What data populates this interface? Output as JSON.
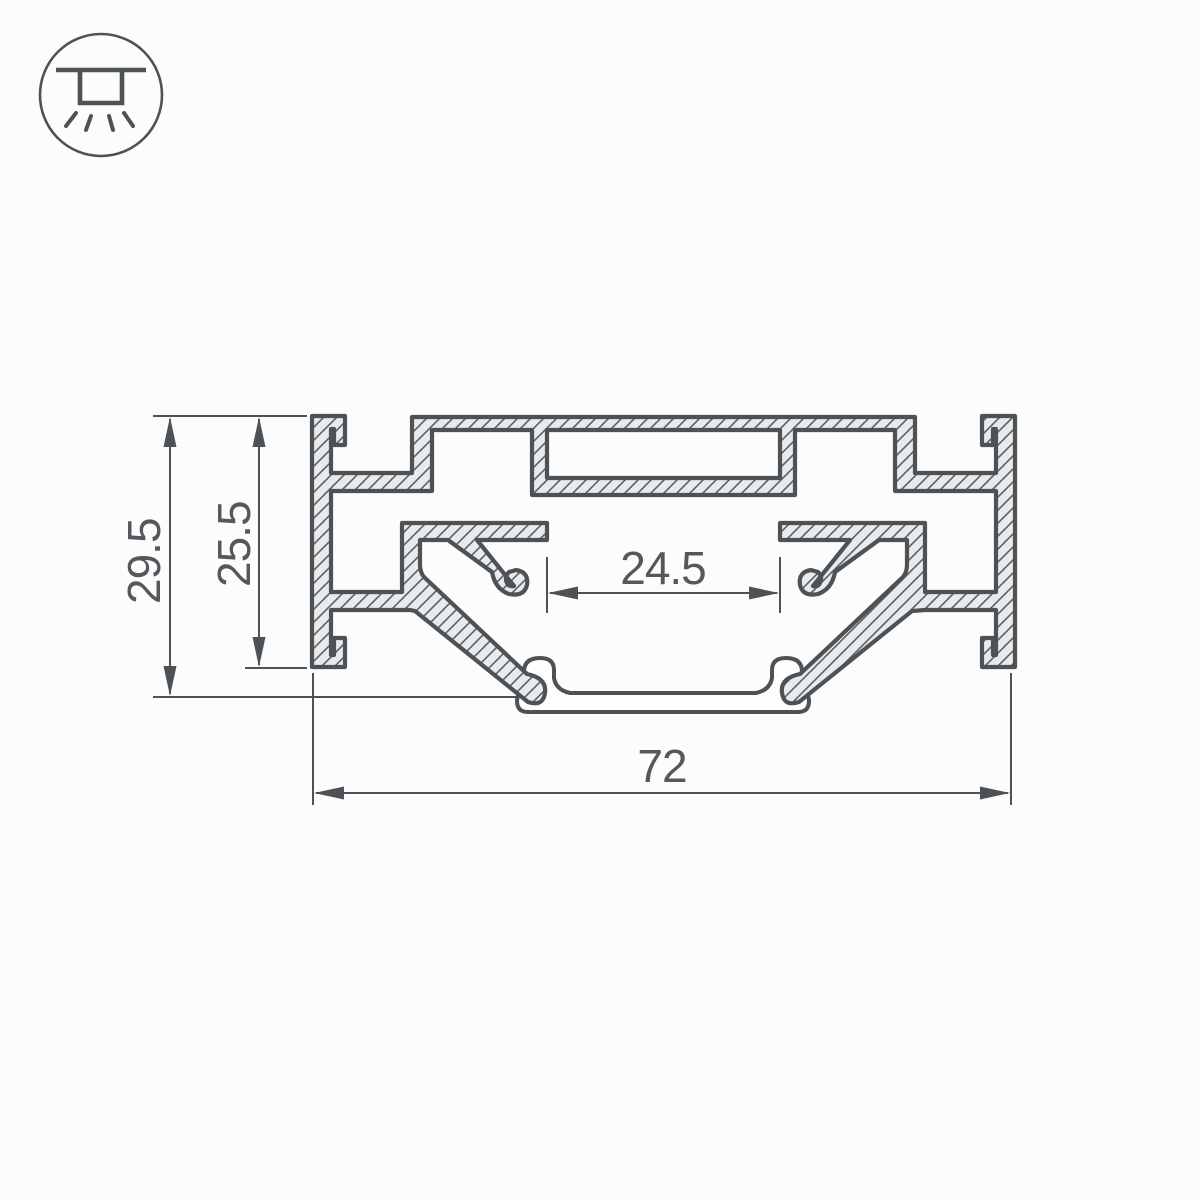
{
  "icon": {
    "name": "surface-mounted-ceiling-light",
    "description": "mounting type symbol: luminaire recessed in ceiling with light rays downward"
  },
  "drawing": {
    "type": "aluminum-profile-cross-section",
    "dimensions": {
      "overall_height": "29.5",
      "body_height": "25.5",
      "channel_width": "24.5",
      "overall_width": "72"
    }
  },
  "colors": {
    "line": "#4d5256",
    "text": "#54585c",
    "profile_fill": "#e9eaec",
    "hatch_line": "#5c6165",
    "diffuser_fill": "#fdfdfe",
    "background": "#fcfcfc"
  }
}
